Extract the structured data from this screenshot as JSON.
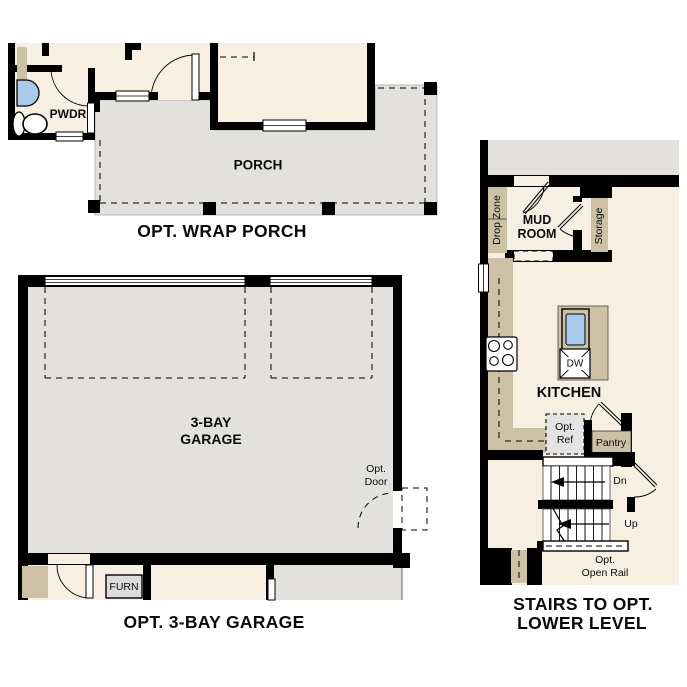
{
  "colors": {
    "wall": "#000000",
    "interior_floor": "#F7EFE2",
    "exterior_floor": "#E2E1DE",
    "cabinetry": "#CCC0A5",
    "sink_fill": "#A9CAE9",
    "appliance_box": "#DCDCDC"
  },
  "sections": {
    "wrap_porch": {
      "caption": "OPT. WRAP PORCH",
      "labels": {
        "pwdr": "PWDR",
        "porch": "PORCH"
      }
    },
    "garage": {
      "caption": "OPT. 3-BAY GARAGE",
      "labels": {
        "garage_line1": "3-BAY",
        "garage_line2": "GARAGE",
        "opt_door_line1": "Opt.",
        "opt_door_line2": "Door",
        "furnace": "FURN"
      }
    },
    "stairs": {
      "caption_line1": "STAIRS TO OPT.",
      "caption_line2": "LOWER LEVEL",
      "labels": {
        "drop_zone": "Drop Zone",
        "mud_room_line1": "MUD",
        "mud_room_line2": "ROOM",
        "storage": "Storage",
        "kitchen": "KITCHEN",
        "dishwasher": "DW",
        "opt_ref_line1": "Opt.",
        "opt_ref_line2": "Ref",
        "pantry": "Pantry",
        "down": "Dn",
        "up": "Up",
        "open_rail_line1": "Opt.",
        "open_rail_line2": "Open Rail"
      }
    }
  }
}
